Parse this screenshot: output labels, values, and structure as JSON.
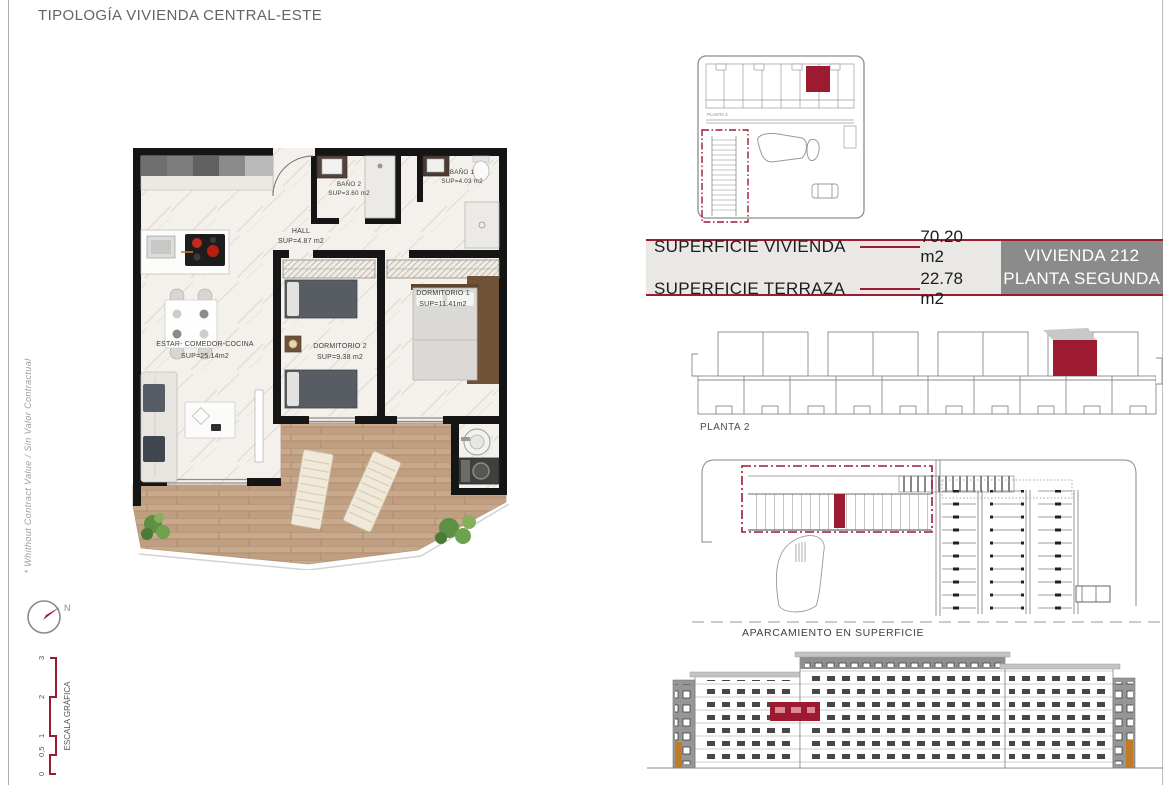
{
  "page": {
    "title": "TIPOLOGÍA VIVIENDA CENTRAL-ESTE",
    "side_note": "* Whithout Contract Value / Sin Valor Contractual"
  },
  "colors": {
    "accent_red": "#9c1b31",
    "unit_box_gray": "#8b8b8b",
    "table_background": "#eae8e4",
    "wall_black": "#151515",
    "terrace_wood": "#c4a487"
  },
  "floor_plan": {
    "rooms": {
      "estar": {
        "name": "ESTAR-  COMEDOR-COCINA",
        "area": "SUP=25.14m2"
      },
      "hall": {
        "name": "HALL",
        "area": "SUP=4.87  m2"
      },
      "bano1": {
        "name": "BAÑO  1",
        "area": "SUP=4.03  m2"
      },
      "bano2": {
        "name": "BAÑO  2",
        "area": "SUP=3.60  m2"
      },
      "dormitorio1": {
        "name": "DORMITORIO  1",
        "area": "SUP=11.41m2"
      },
      "dormitorio2": {
        "name": "DORMITORIO  2",
        "area": "SUP=9.38  m2"
      }
    }
  },
  "summary_table": {
    "rows": [
      {
        "label": "SUPERFICIE VIVIENDA",
        "value": "70.20 m2"
      },
      {
        "label": "SUPERFICIE TERRAZA",
        "value": "22.78 m2"
      }
    ],
    "unit_box": {
      "line1": "VIVIENDA 212",
      "line2": "PLANTA SEGUNDA"
    }
  },
  "site_plan": {
    "label": "PLANTA 2"
  },
  "floor_overview": {
    "label": "PLANTA 2"
  },
  "parking": {
    "label": "APARCAMIENTO EN SUPERFICIE"
  },
  "compass": {
    "north_label": "N"
  },
  "scale_bar": {
    "label": "ESCALA GRÁFICA",
    "ticks": [
      "0",
      "0,5",
      "1",
      "2",
      "3"
    ]
  }
}
